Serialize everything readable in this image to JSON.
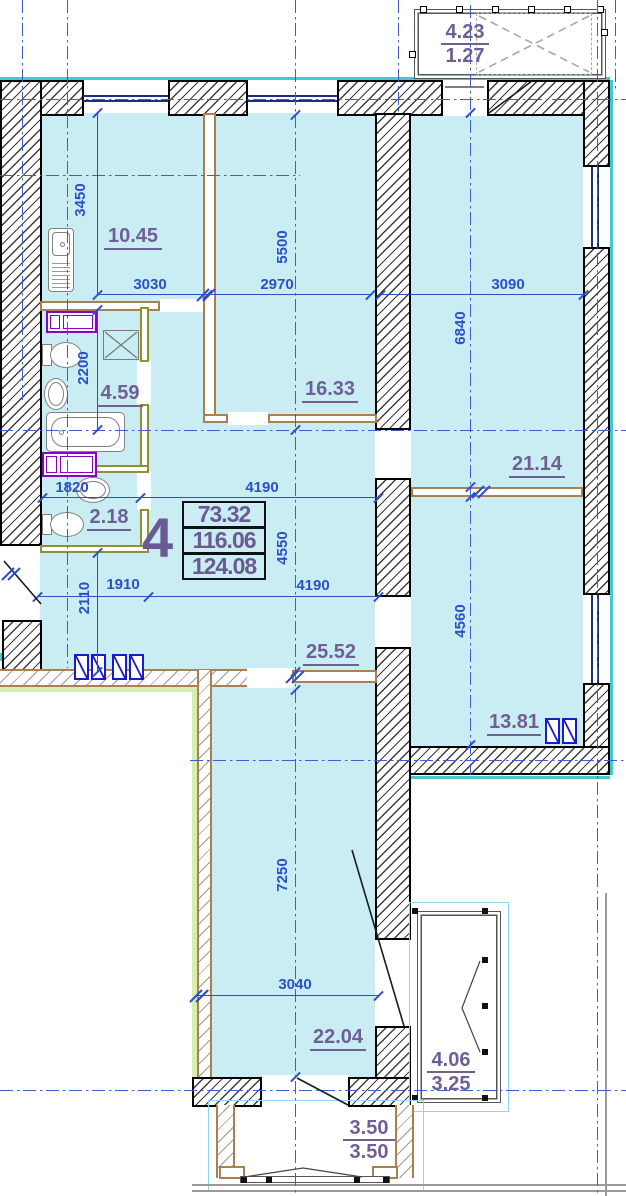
{
  "drawing": {
    "summary": {
      "apartment_number": "4",
      "areas": [
        "73.32",
        "116.06",
        "124.08"
      ]
    },
    "rooms": {
      "kitchen": "10.45",
      "bedroom_top": "16.33",
      "bathroom": "4.59",
      "wc": "2.18",
      "bedroom_right": "21.14",
      "hall": "25.52",
      "bedroom_bottom_right": "13.81",
      "living_room": "22.04"
    },
    "balconies": {
      "top": {
        "area_full": "4.23",
        "area_counted": "1.27"
      },
      "right": {
        "area_full": "4.06",
        "area_counted": "3.25"
      },
      "bottom": {
        "area_full": "3.50",
        "area_counted": "3.50"
      }
    },
    "dims": {
      "kitchen_height": "3450",
      "kitchen_width": "3030",
      "bedroom_top_width": "2970",
      "bedroom_top_height": "5500",
      "bedroom_right_width": "3090",
      "bedroom_right_height": "6840",
      "bathroom_height": "2200",
      "wc_width": "1820",
      "hall_width_top": "4190",
      "hall_height": "4550",
      "hall_width_bottom": "4190",
      "hall_left_width": "1910",
      "hall_left_height": "2110",
      "bedroom_br_height": "4560",
      "living_height": "7250",
      "living_width": "3040"
    },
    "colors": {
      "floor_fill": "#c9edf2",
      "dimension_blue": "#2b50c8",
      "label_purple": "#6f5f95",
      "partition_brown": "#ab7f50",
      "partition_olive": "#8f9030",
      "window_navy": "#1c2f80",
      "face_teal": "#45c8cf",
      "axis_blue": "#3f5bd6",
      "panel_blue": "#1a1acd",
      "fixture_purple": "#8800cc",
      "outside_green": "#d8edb0"
    }
  }
}
